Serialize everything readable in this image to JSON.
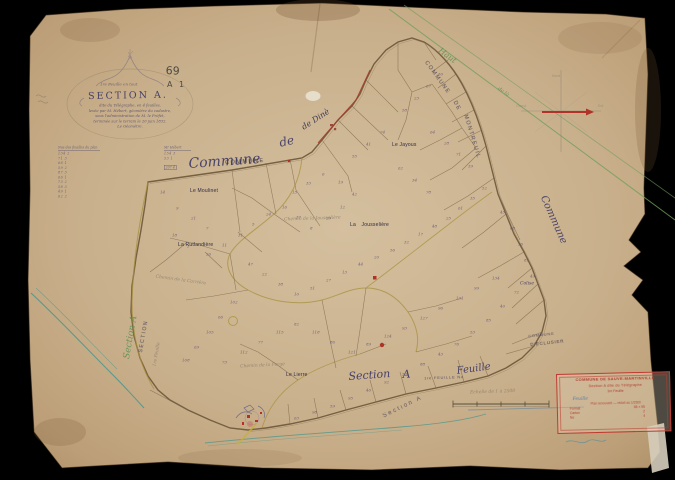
{
  "page": {
    "type": "scanned cadastral map sheet",
    "background": "#000000"
  },
  "colors": {
    "paper": "#cdb794",
    "paper_edge": "#ab8e65",
    "ink": "#6b5638",
    "ink_dark": "#4a4468",
    "purple_ink": "#5e4b74",
    "red": "#a93528",
    "green": "#6f9d5c",
    "teal": "#54988c",
    "olive": "#a8913e",
    "blue_pencil": "#6a87a0",
    "pencil": "#7d7668"
  },
  "cartouche": {
    "overline": "1re Feuille en tout",
    "title": "SECTION A.",
    "lines": [
      "dite du Télégraphe, en 4 feuilles,",
      "levée par M. Hébert, géomètre du cadastre,",
      "sous l'administration de M. le Préfet,",
      "terminée sur le terrain le 20 juin 1832.",
      "Le Géomètre."
    ]
  },
  "pencil_notes": {
    "sheet_number": "69",
    "reference": "A 1"
  },
  "margin_tables": {
    "left": {
      "header": "Nos des feuilles du plan",
      "rows": [
        "134 2",
        "71 3",
        "68 1",
        "59 2",
        "87 3",
        "66 1",
        "73 2",
        "58 3",
        "49 1",
        "62 2"
      ]
    },
    "right": {
      "header": "Mr Hébert",
      "rows": [
        "154 3",
        "53 1"
      ],
      "total": "207 4"
    }
  },
  "boundary_text": {
    "commune_script": "Commune",
    "commune_stamp": "COMMUNE",
    "de_script": "de",
    "dine_script": "de Dinè",
    "top_right_stamp_1": "COMMUNE",
    "top_right_stamp_2": "DE",
    "top_right_stamp_3": "MONTREUIL",
    "right_script": "Commune",
    "green_script_1": "Haut",
    "green_script_2": "de là",
    "left_green_script": "Section A",
    "left_stamp": "SECTION",
    "left_faint_script": "1re Feuille",
    "neighbor_stamp_1": "COMMUNE",
    "neighbor_stamp_2": "D'ECLUSIER"
  },
  "place_labels": {
    "moulinet": "Le Moulinet",
    "rutlandiere": "La Rutlandière",
    "jousseliere": "La Jousselière",
    "jayous": "Le Jayous",
    "colise": "Colise",
    "lierre": "Le Lierre",
    "chemin_1": "Chemin de la Jousselière",
    "chemin_2": "Chemin de la Forge",
    "chemin_3": "Chemin de la Carrière"
  },
  "bottom_strip": {
    "section_script": "Section",
    "section_letter": "A",
    "feuille_stamp": "1re FEUILLE No",
    "feuille_script": "Feuille",
    "echelle": "Echelle de 1 à 2500",
    "section_stamp": "Section A"
  },
  "compass": {
    "north": "Nord",
    "east": "Est",
    "west": "Ouest"
  },
  "legend": {
    "line1": "COMMUNE DE SAUVE-MARTINVILLE",
    "line2": "Section A dite du Télégraphe",
    "line3": "1re Feuille",
    "blue_note": "Feuille",
    "line4": "Plan renouvelé — réduit au 1/2500",
    "rows": [
      {
        "label": "Format",
        "value": "65 × 95"
      },
      {
        "label": "Carton",
        "value": "2"
      },
      {
        "label": "No",
        "value": "4"
      }
    ]
  },
  "parcel_numbers": [
    {
      "x": 160,
      "y": 190,
      "n": "14"
    },
    {
      "x": 176,
      "y": 206,
      "n": "9"
    },
    {
      "x": 191,
      "y": 216,
      "n": "21"
    },
    {
      "x": 206,
      "y": 226,
      "n": "7"
    },
    {
      "x": 172,
      "y": 233,
      "n": "18"
    },
    {
      "x": 187,
      "y": 244,
      "n": "3"
    },
    {
      "x": 206,
      "y": 252,
      "n": "26"
    },
    {
      "x": 222,
      "y": 243,
      "n": "11"
    },
    {
      "x": 238,
      "y": 233,
      "n": "31"
    },
    {
      "x": 252,
      "y": 222,
      "n": "5"
    },
    {
      "x": 266,
      "y": 212,
      "n": "24"
    },
    {
      "x": 282,
      "y": 205,
      "n": "16"
    },
    {
      "x": 296,
      "y": 215,
      "n": "37"
    },
    {
      "x": 310,
      "y": 226,
      "n": "8"
    },
    {
      "x": 326,
      "y": 216,
      "n": "29"
    },
    {
      "x": 340,
      "y": 205,
      "n": "12"
    },
    {
      "x": 352,
      "y": 192,
      "n": "42"
    },
    {
      "x": 338,
      "y": 180,
      "n": "19"
    },
    {
      "x": 322,
      "y": 172,
      "n": "6"
    },
    {
      "x": 306,
      "y": 181,
      "n": "33"
    },
    {
      "x": 292,
      "y": 190,
      "n": "15"
    },
    {
      "x": 248,
      "y": 262,
      "n": "47"
    },
    {
      "x": 262,
      "y": 272,
      "n": "22"
    },
    {
      "x": 278,
      "y": 282,
      "n": "38"
    },
    {
      "x": 294,
      "y": 292,
      "n": "10"
    },
    {
      "x": 310,
      "y": 286,
      "n": "51"
    },
    {
      "x": 326,
      "y": 278,
      "n": "27"
    },
    {
      "x": 342,
      "y": 270,
      "n": "13"
    },
    {
      "x": 358,
      "y": 262,
      "n": "44"
    },
    {
      "x": 374,
      "y": 255,
      "n": "20"
    },
    {
      "x": 390,
      "y": 248,
      "n": "56"
    },
    {
      "x": 404,
      "y": 240,
      "n": "32"
    },
    {
      "x": 418,
      "y": 232,
      "n": "17"
    },
    {
      "x": 432,
      "y": 224,
      "n": "48"
    },
    {
      "x": 446,
      "y": 216,
      "n": "25"
    },
    {
      "x": 458,
      "y": 206,
      "n": "61"
    },
    {
      "x": 470,
      "y": 196,
      "n": "35"
    },
    {
      "x": 482,
      "y": 186,
      "n": "52"
    },
    {
      "x": 430,
      "y": 130,
      "n": "64"
    },
    {
      "x": 444,
      "y": 141,
      "n": "28"
    },
    {
      "x": 456,
      "y": 152,
      "n": "71"
    },
    {
      "x": 468,
      "y": 164,
      "n": "39"
    },
    {
      "x": 402,
      "y": 108,
      "n": "58"
    },
    {
      "x": 414,
      "y": 96,
      "n": "23"
    },
    {
      "x": 426,
      "y": 84,
      "n": "67"
    },
    {
      "x": 438,
      "y": 72,
      "n": "30"
    },
    {
      "x": 380,
      "y": 130,
      "n": "74"
    },
    {
      "x": 366,
      "y": 142,
      "n": "41"
    },
    {
      "x": 352,
      "y": 154,
      "n": "55"
    },
    {
      "x": 398,
      "y": 166,
      "n": "62"
    },
    {
      "x": 412,
      "y": 178,
      "n": "34"
    },
    {
      "x": 426,
      "y": 190,
      "n": "78"
    },
    {
      "x": 500,
      "y": 210,
      "n": "45"
    },
    {
      "x": 510,
      "y": 226,
      "n": "68"
    },
    {
      "x": 518,
      "y": 242,
      "n": "36"
    },
    {
      "x": 524,
      "y": 258,
      "n": "81"
    },
    {
      "x": 530,
      "y": 274,
      "n": "49"
    },
    {
      "x": 514,
      "y": 290,
      "n": "72"
    },
    {
      "x": 500,
      "y": 304,
      "n": "40"
    },
    {
      "x": 486,
      "y": 318,
      "n": "85"
    },
    {
      "x": 470,
      "y": 330,
      "n": "53"
    },
    {
      "x": 454,
      "y": 342,
      "n": "76"
    },
    {
      "x": 438,
      "y": 352,
      "n": "43"
    },
    {
      "x": 420,
      "y": 362,
      "n": "88"
    },
    {
      "x": 402,
      "y": 372,
      "n": "57"
    },
    {
      "x": 384,
      "y": 380,
      "n": "92"
    },
    {
      "x": 366,
      "y": 388,
      "n": "46"
    },
    {
      "x": 348,
      "y": 396,
      "n": "95"
    },
    {
      "x": 330,
      "y": 404,
      "n": "59"
    },
    {
      "x": 312,
      "y": 410,
      "n": "98"
    },
    {
      "x": 294,
      "y": 416,
      "n": "63"
    },
    {
      "x": 230,
      "y": 300,
      "n": "102"
    },
    {
      "x": 218,
      "y": 315,
      "n": "66"
    },
    {
      "x": 206,
      "y": 330,
      "n": "105"
    },
    {
      "x": 194,
      "y": 345,
      "n": "69"
    },
    {
      "x": 182,
      "y": 358,
      "n": "108"
    },
    {
      "x": 222,
      "y": 360,
      "n": "73"
    },
    {
      "x": 240,
      "y": 350,
      "n": "112"
    },
    {
      "x": 258,
      "y": 340,
      "n": "77"
    },
    {
      "x": 276,
      "y": 330,
      "n": "115"
    },
    {
      "x": 294,
      "y": 322,
      "n": "82"
    },
    {
      "x": 312,
      "y": 330,
      "n": "118"
    },
    {
      "x": 330,
      "y": 340,
      "n": "86"
    },
    {
      "x": 348,
      "y": 350,
      "n": "121"
    },
    {
      "x": 366,
      "y": 342,
      "n": "89"
    },
    {
      "x": 384,
      "y": 334,
      "n": "124"
    },
    {
      "x": 402,
      "y": 326,
      "n": "93"
    },
    {
      "x": 420,
      "y": 316,
      "n": "127"
    },
    {
      "x": 438,
      "y": 306,
      "n": "96"
    },
    {
      "x": 456,
      "y": 296,
      "n": "131"
    },
    {
      "x": 474,
      "y": 286,
      "n": "99"
    },
    {
      "x": 492,
      "y": 276,
      "n": "134"
    }
  ]
}
